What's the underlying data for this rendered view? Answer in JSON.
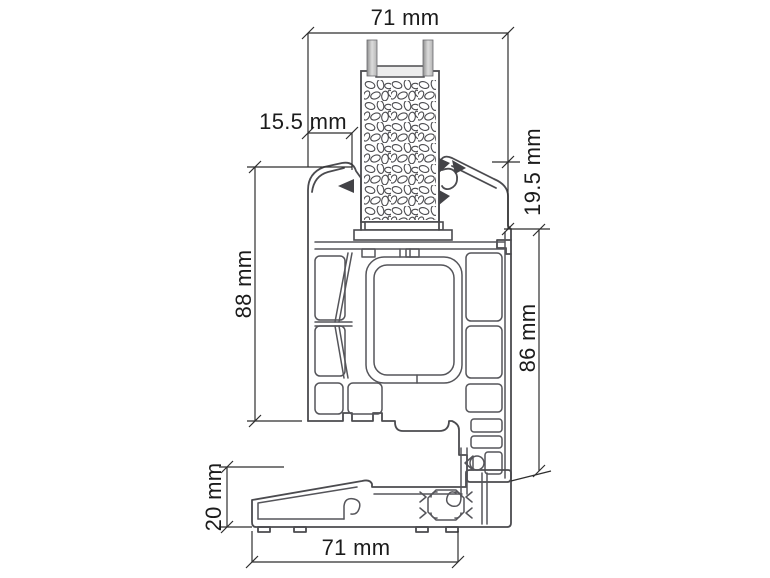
{
  "drawing": {
    "dims": {
      "top_width": "71 mm",
      "glazing_inset": "15.5 mm",
      "bead_height": "19.5 mm",
      "frame_height": "88 mm",
      "sash_height": "86 mm",
      "sill_height": "20 mm",
      "sill_depth": "71 mm"
    },
    "colors": {
      "background": "#ffffff",
      "profile_line": "#4b4b4f",
      "detail_line": "#55555a",
      "dimension_line": "#2e2e2e",
      "text": "#1b1b1b",
      "glass_pane_dark": "#8f8f8f",
      "glass_pane_light": "#dcdcdc",
      "spacer_fill": "#ececec",
      "gasket_dark": "#434347"
    }
  }
}
